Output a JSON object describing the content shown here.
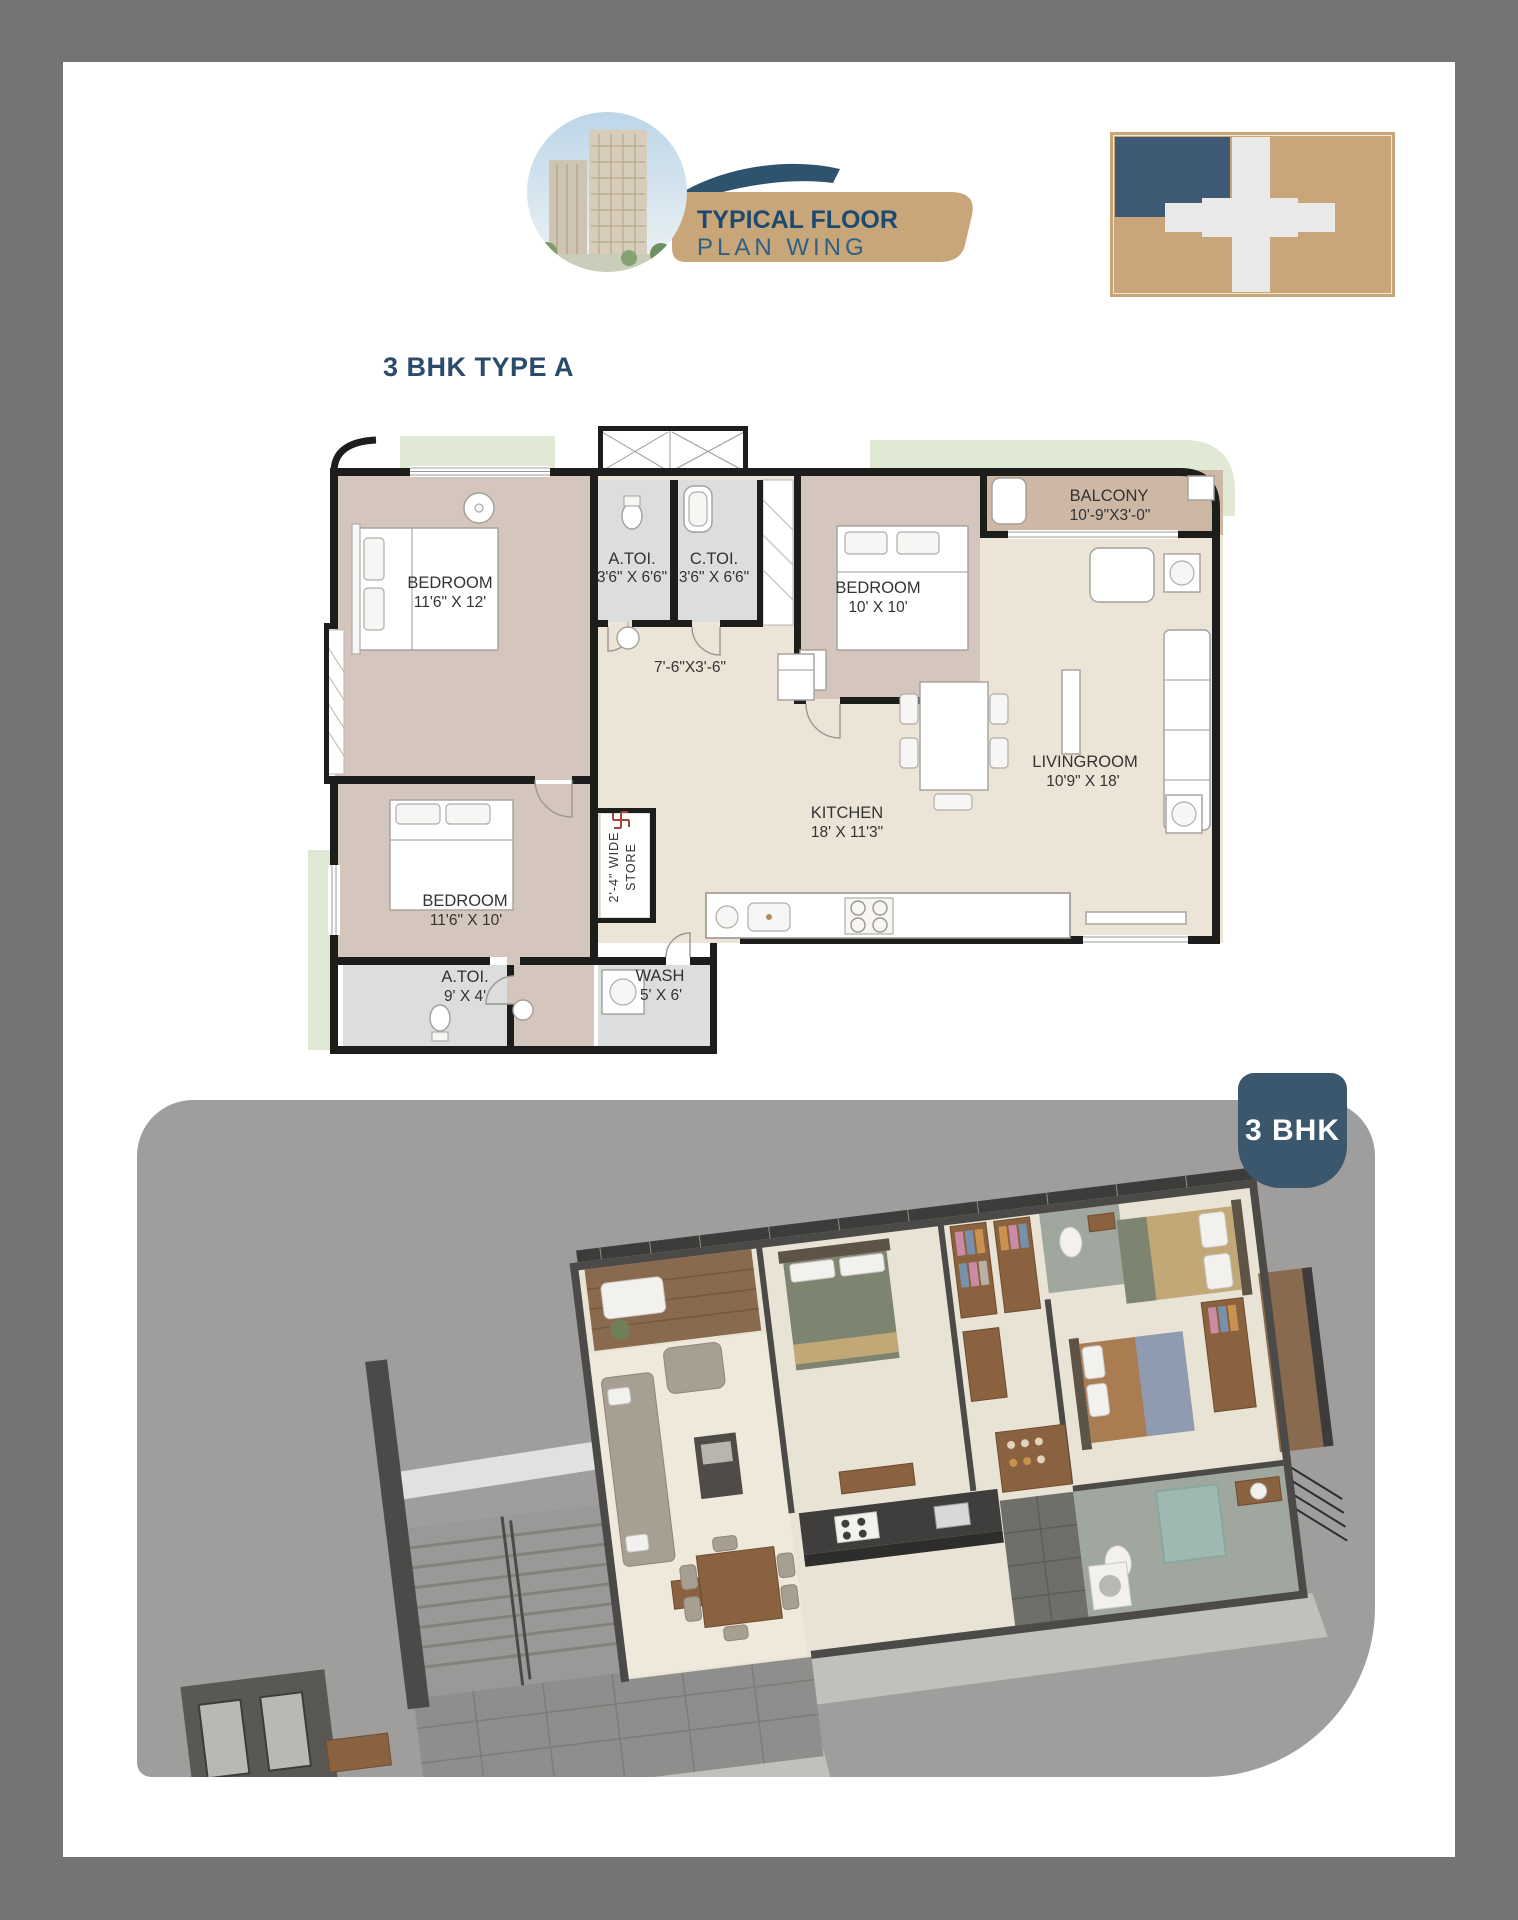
{
  "header": {
    "title_line1": "TYPICAL FLOOR",
    "title_line2": "PLAN WING"
  },
  "heading": "3 BHK TYPE A",
  "badge": "3 BHK",
  "floor_plan": {
    "rooms": {
      "bedroom_tl": {
        "name": "BEDROOM",
        "dims": "11'6\" X 12'"
      },
      "atoi1": {
        "name": "A.TOI.",
        "dims": "3'6\" X 6'6\""
      },
      "ctoi": {
        "name": "C.TOI.",
        "dims": "3'6\" X 6'6\""
      },
      "bedroom_tr": {
        "name": "BEDROOM",
        "dims": "10' X 10'"
      },
      "balcony": {
        "name": "BALCONY",
        "dims": "10'-9\"X3'-0\""
      },
      "living": {
        "name": "LIVINGROOM",
        "dims": "10'9\" X 18'"
      },
      "kitchen": {
        "name": "KITCHEN",
        "dims": "18' X 11'3\""
      },
      "bedroom_bl": {
        "name": "BEDROOM",
        "dims": "11'6\" X 10'"
      },
      "atoi2": {
        "name": "A.TOI.",
        "dims": "9' X 4'"
      },
      "wash": {
        "name": "WASH",
        "dims": "5' X 6'"
      }
    },
    "passage_dims": "7'-6\"X3'-6\"",
    "store_line1": "2'-4\" WIDE",
    "store_line2": "STORE"
  },
  "colors": {
    "frame_gray": "#747474",
    "panel_gray": "#9f9e9c",
    "accent_navy": "#2b4b6d",
    "title_navy": "#1d4a70",
    "subtitle_blue": "#2f6184",
    "swoosh_blue": "#2e536e",
    "banner_tan": "#c8a679",
    "logo_blue": "#3e5a74",
    "cross_white": "#e9e9e8",
    "badge_blue": "#3b576e",
    "wall": "#1d1d1b",
    "floor_mauve": "#d4c6bd",
    "floor_cream": "#ece4d6",
    "floor_gray": "#dcdddd",
    "balcony_tan": "#cdb7a5",
    "planter_green": "#dfe9d3"
  }
}
